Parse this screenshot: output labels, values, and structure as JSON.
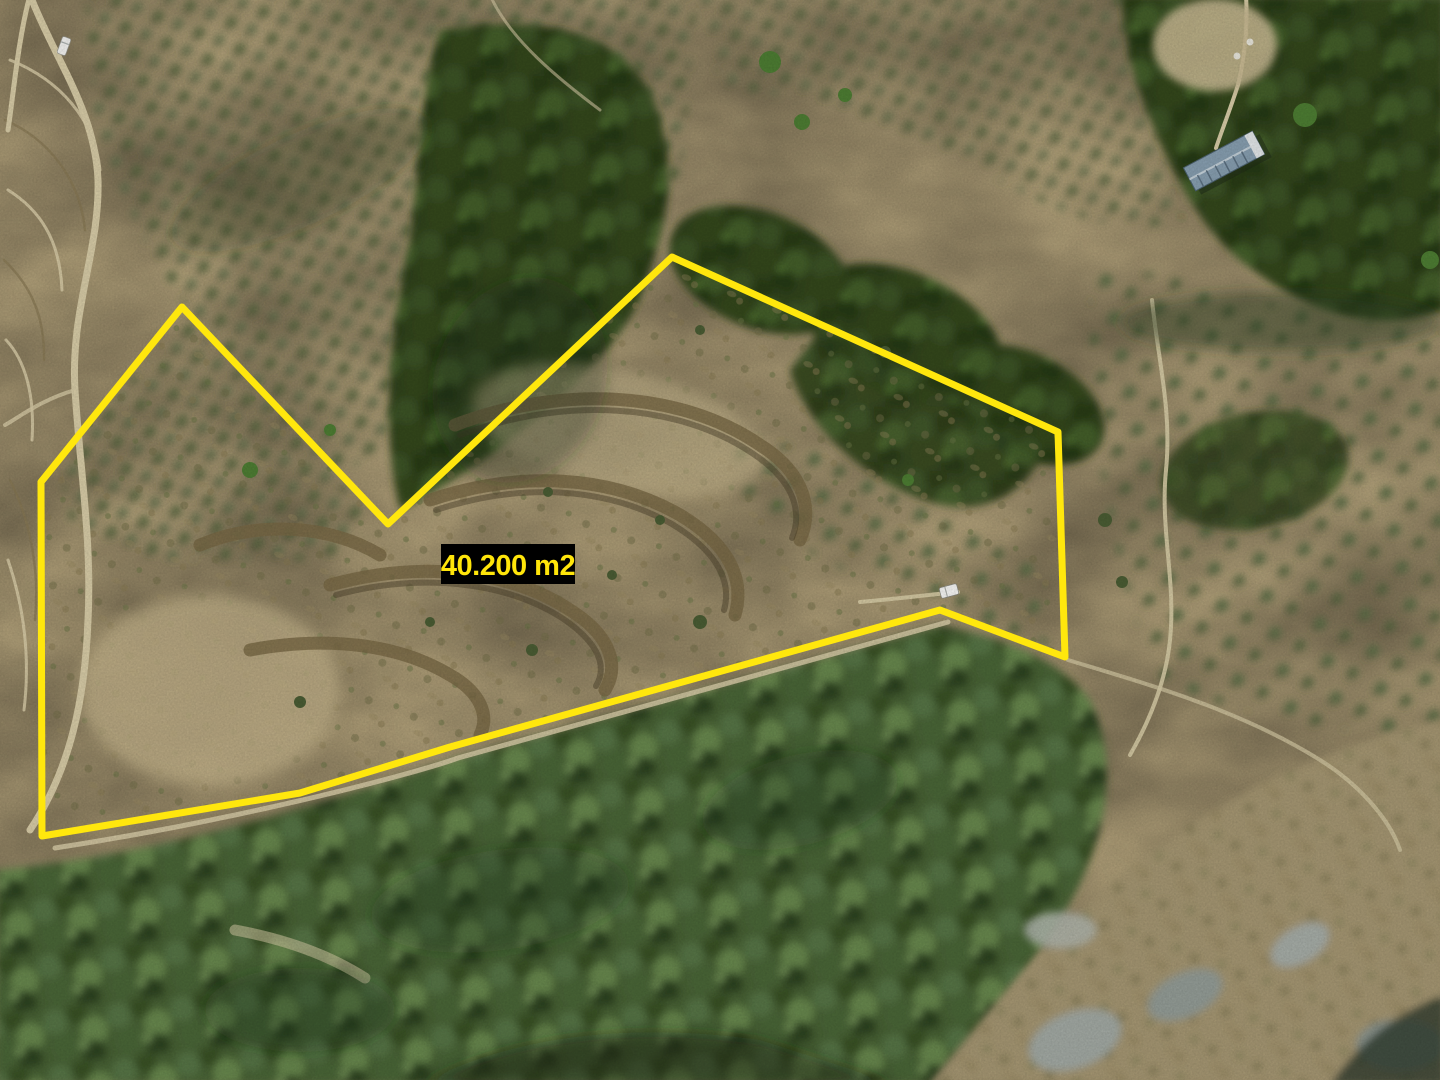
{
  "annotation": {
    "area_label": "40.200 m2",
    "boundary_color": "#ffe70d",
    "label_bg_color": "#000000",
    "label_text_color": "#ffe50a",
    "polygon_points": "41,482 182,307 388,524 672,257 1058,432 1065,657 940,610 450,747 300,793 150,818 42,836"
  },
  "scene": {
    "description": "Aerial drone photograph of a hillside land parcel outlined in yellow, surrounded by olive groves, dense forest, terraced scrubland and dirt roads",
    "objects": [
      "olive-grove-rows",
      "dense-forest",
      "terraced-scrubland",
      "dirt-roads",
      "blue-roof-building",
      "white-vehicle-on-road",
      "white-vehicle-in-parcel",
      "rocky-outcrops"
    ]
  }
}
